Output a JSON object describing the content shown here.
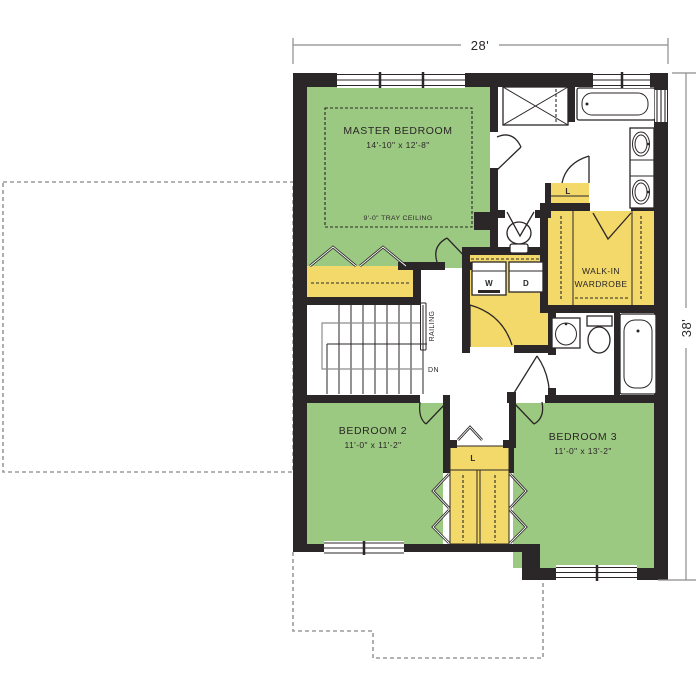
{
  "drawing": {
    "dimensions": {
      "top": "28'",
      "right": "38'"
    },
    "rooms": {
      "master_bedroom": {
        "name": "MASTER BEDROOM",
        "size": "14'-10\" x 12'-8\"",
        "ceiling_note": "9'-0\" TRAY CEILING"
      },
      "walk_in_wardrobe": {
        "name_line1": "WALK-IN",
        "name_line2": "WARDROBE"
      },
      "bedroom_2": {
        "name": "BEDROOM 2",
        "size": "11'-0\" x 11'-2\""
      },
      "bedroom_3": {
        "name": "BEDROOM 3",
        "size": "11'-0\" x 13'-2\""
      }
    },
    "labels": {
      "washer": "W",
      "dryer": "D",
      "linen_bath": "L",
      "linen_hall": "L",
      "railing": "RAILING",
      "down": "DN"
    },
    "colors": {
      "bedroom_fill": "#9cc982",
      "closet_fill": "#f2d969",
      "wall": "#2b2627",
      "dimension_line": "#8c8c8c",
      "roof_dashed": "#9b9b9b"
    }
  }
}
